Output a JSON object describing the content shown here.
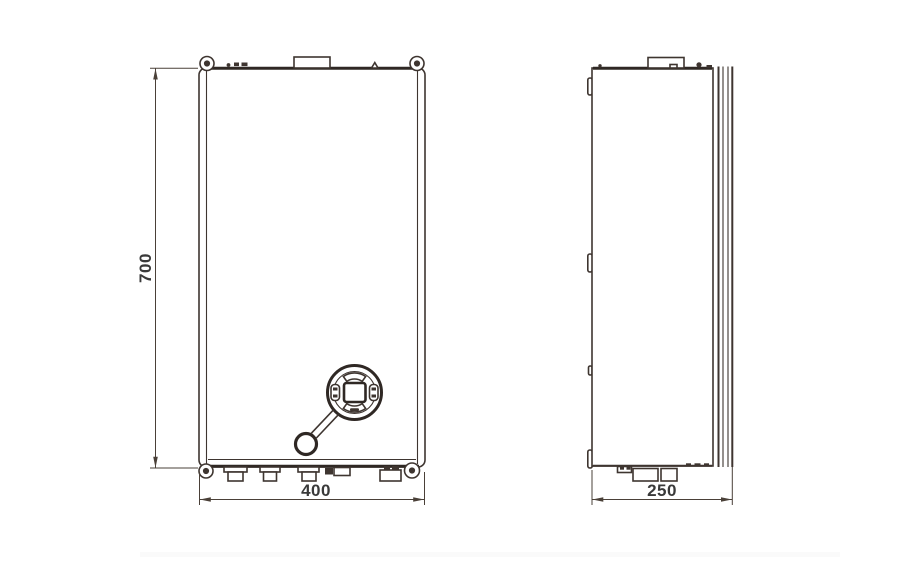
{
  "drawing": {
    "kind": "orthographic-dimension-drawing",
    "dimensions": {
      "height": "700",
      "width": "400",
      "depth": "250"
    },
    "colors": {
      "background": "#ffffff",
      "line": "#3e3530",
      "edge": "#2f2824",
      "text": "#3a3a3a"
    }
  }
}
